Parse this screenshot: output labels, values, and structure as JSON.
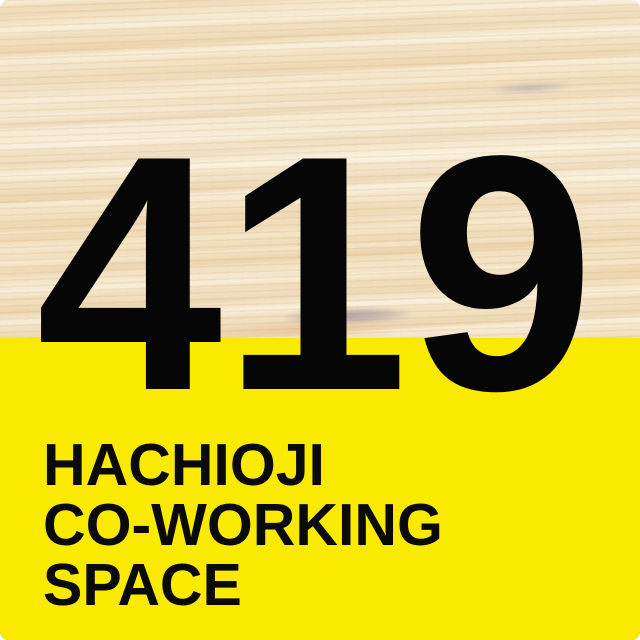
{
  "logo": {
    "number": "419",
    "title_lines": [
      "HACHIOJI",
      "CO-WORKING",
      "SPACE"
    ],
    "colors": {
      "panel_yellow": "#F9EA00",
      "text_black": "#0A0A0A",
      "wood_base": "#F2E3C5"
    }
  }
}
